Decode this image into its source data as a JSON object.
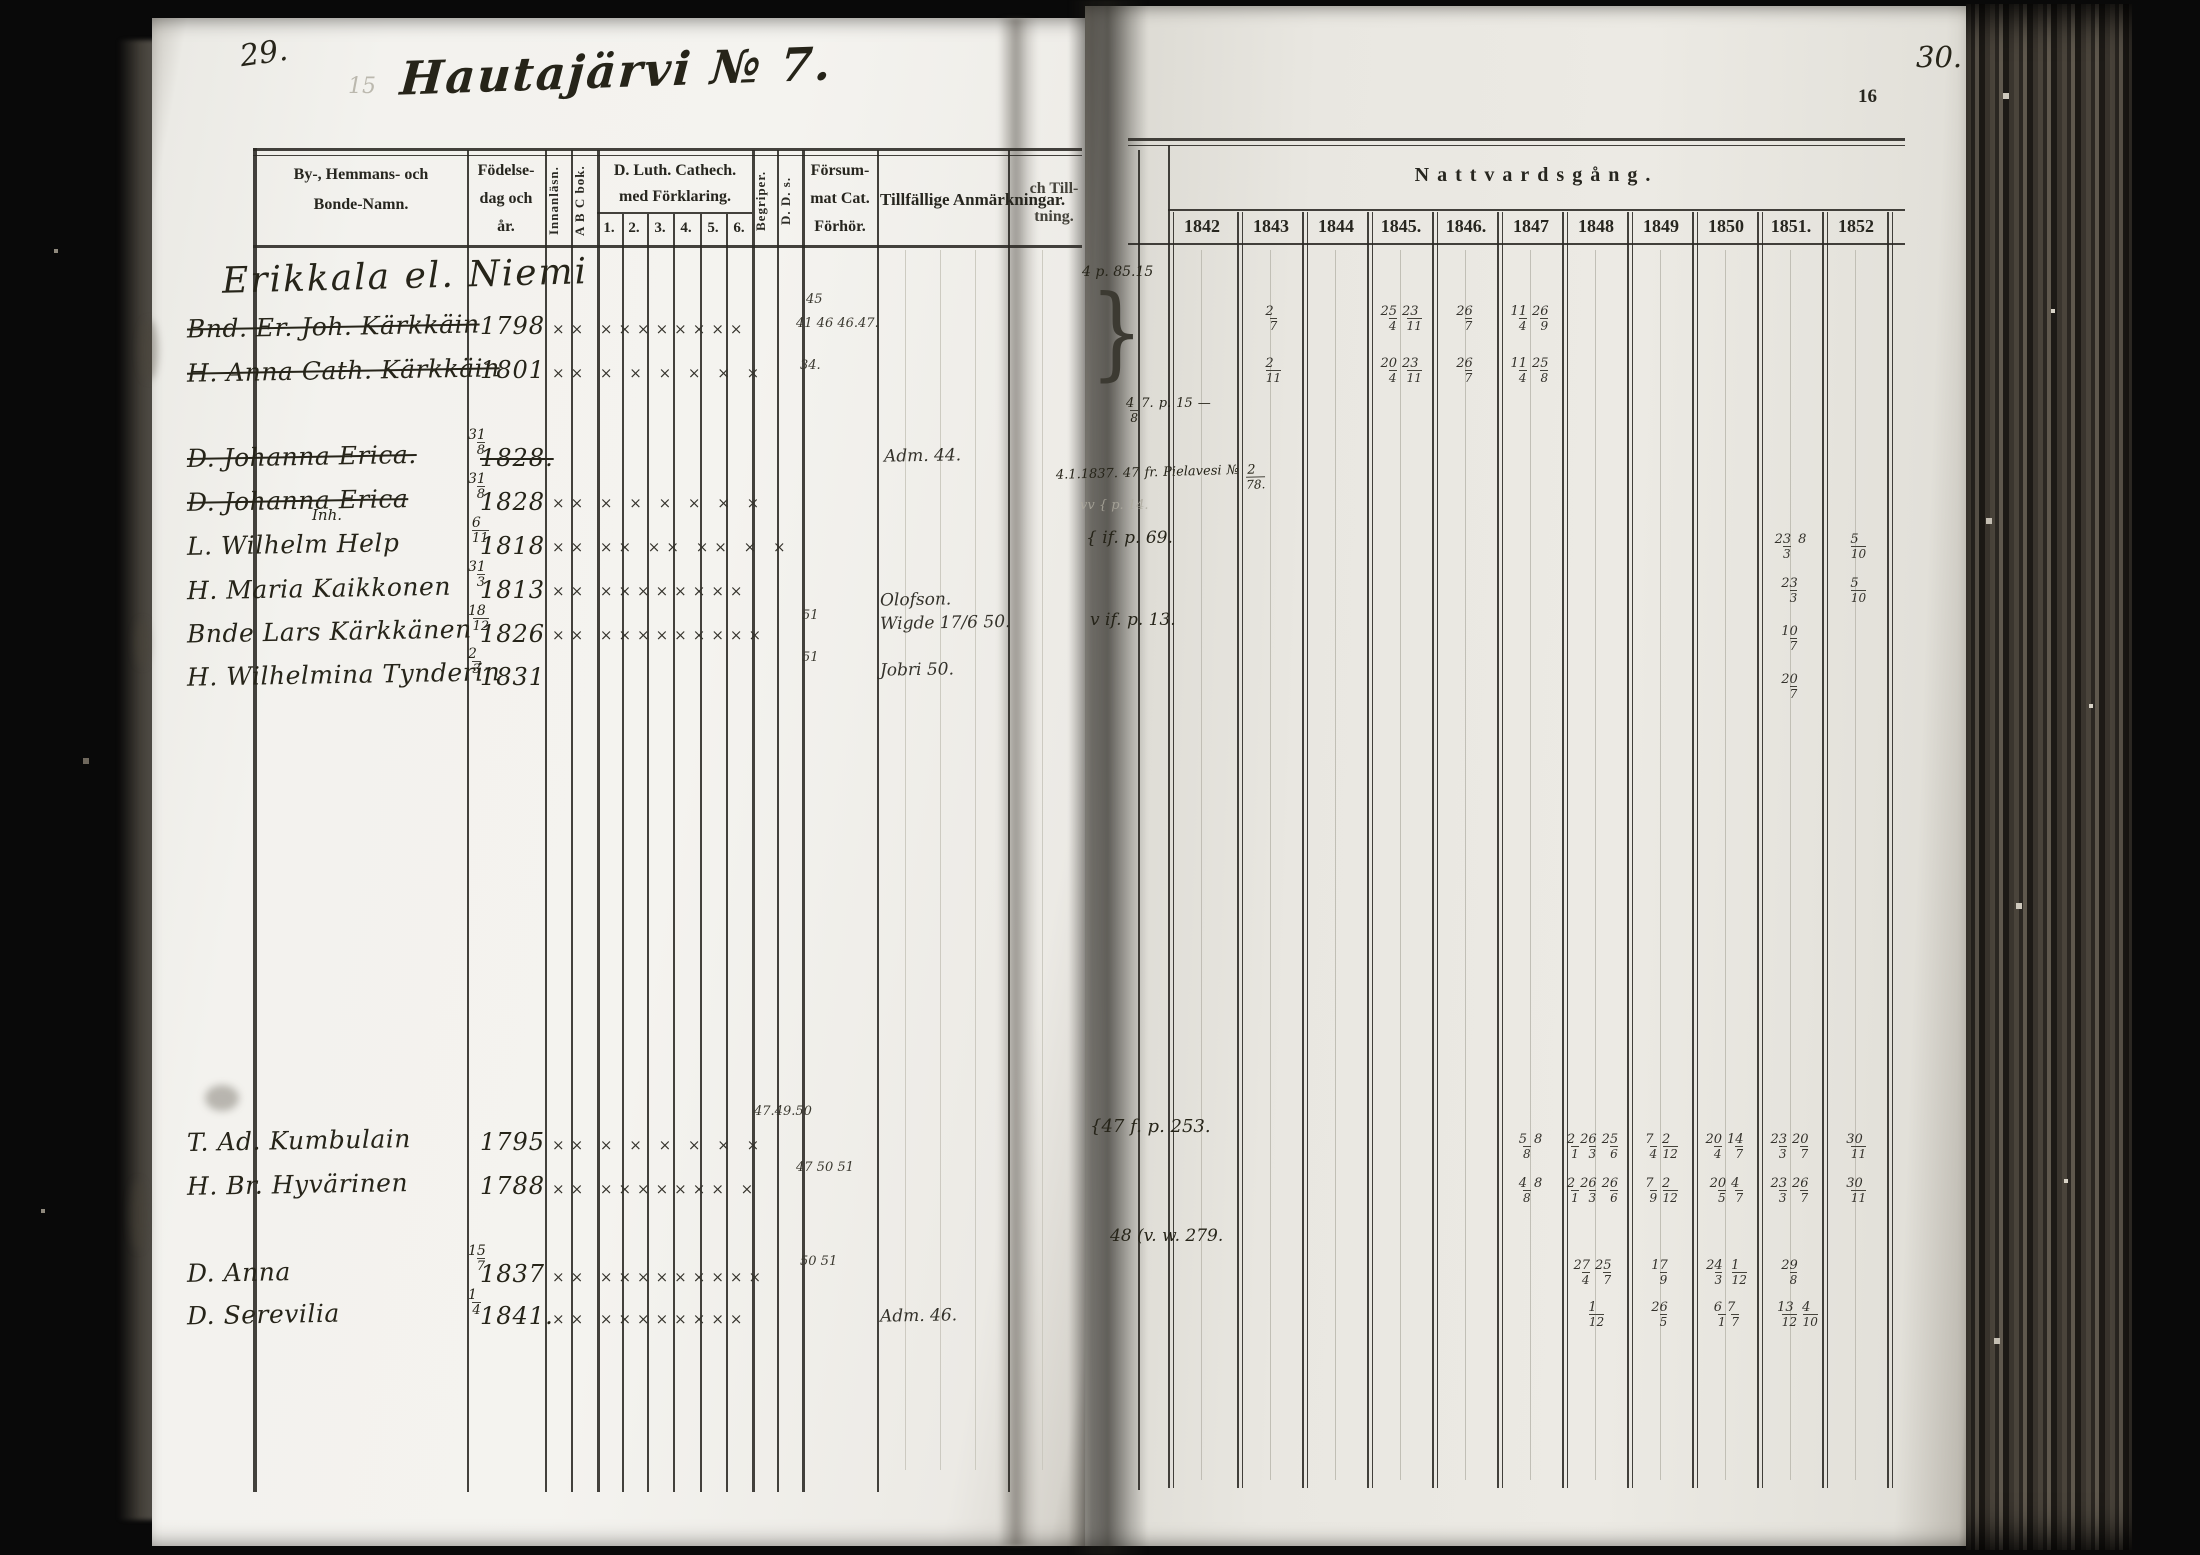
{
  "scan": {
    "left_folio": "29.",
    "ghost_number": "15",
    "title": "Hautajärvi № 7.",
    "right_folio": "30.",
    "printed_folio": "16",
    "section_heading": "Erikkala el. Niemi"
  },
  "headers": {
    "name_col": [
      "By-, Hemmans- och",
      "Bonde-Namn."
    ],
    "birth_col": [
      "Födelse-",
      "dag och",
      "år."
    ],
    "innanlasning": "Innanläsn.",
    "abc_book": "A B C bok.",
    "cathech": [
      "D. Luth. Cathech.",
      "med Förklaring."
    ],
    "cathech_nums": [
      "1.",
      "2.",
      "3.",
      "4.",
      "5.",
      "6."
    ],
    "begriper": "Begriper.",
    "dds": "D. D. s.",
    "forsummat": [
      "Försum-",
      "mat Cat.",
      "Förhör."
    ],
    "anmarkningar": "Tillfällige Anmärkningar.",
    "till_partial": [
      "ch Till-",
      "tning."
    ],
    "nattvardsgang": "Nattvardsgång.",
    "years": [
      "1842",
      "1843",
      "1844",
      "1845.",
      "1846.",
      "1847",
      "1848",
      "1849",
      "1850",
      "1851.",
      "1852"
    ]
  },
  "rows": [
    {
      "name": "Bnd. Er. Joh. Kärkkäin",
      "struck": true,
      "frac": "",
      "year": "1798",
      "marks": "×× ××××××××",
      "fors_top": "45",
      "fors": "41 46 46.47.",
      "anm": "",
      "comm": {
        "1843": "2/7",
        "1845": "25/4 23/11",
        "1846": "26/7",
        "1847": "11/4 26/9"
      }
    },
    {
      "name": "H. Anna Cath. Kärkkäin",
      "struck": true,
      "frac": "",
      "year": "1801",
      "marks": "×× × × × × × ×",
      "fors": "34.",
      "anm": "",
      "comm": {
        "1843": "2/11",
        "1845": "20/4 23/11",
        "1846": "26/7",
        "1847": "11/4 25/8"
      }
    },
    {
      "name": "D. Johanna Erica.",
      "struck": true,
      "frac": "31/8",
      "year": "1828.",
      "year_struck": true,
      "marks": "",
      "fors": "",
      "anm": "Adm. 44.",
      "comm": {}
    },
    {
      "name": "D. Johanna Erica",
      "struck": true,
      "frac": "31/8",
      "year": "1828",
      "marks": "×× × × × × × ×",
      "fors": "",
      "anm": "",
      "comm": {}
    },
    {
      "note": "Inh.",
      "name": "L. Wilhelm Help",
      "struck": false,
      "frac": "6/11",
      "year": "1818",
      "marks": "×× ×× ×× ×× × ×",
      "fors": "",
      "anm": "",
      "comm": {
        "1851": "23/3 8",
        "1852": "5/10"
      }
    },
    {
      "name": "H. Maria Kaikkonen",
      "struck": false,
      "frac": "31/3",
      "year": "1813",
      "marks": "×× ××××××××",
      "fors": "",
      "anm": "",
      "comm": {
        "1851": "23/3",
        "1852": "5/10"
      }
    },
    {
      "name": "Bnde Lars Kärkkänen",
      "struck": false,
      "frac": "18/12",
      "year": "1826",
      "marks": "×× ×××××××××",
      "fors": "51",
      "anm": "Olofson.",
      "anm2": "Wigde 17/6 50.",
      "comm": {
        "1851": "10/7"
      }
    },
    {
      "name": "H. Wilhelmina Tynderin",
      "struck": false,
      "frac": "2/3",
      "year": "1831",
      "marks": "",
      "fors": "51",
      "anm": "Jobri 50.",
      "comm": {
        "1851": "20/7"
      }
    },
    {
      "name": "T. Ad. Kumbulain",
      "struck": false,
      "frac": "",
      "year": "1795",
      "marks": "×× × × × × × ×",
      "fors_top": "47.49.50",
      "fors": "",
      "anm": "",
      "comm": {
        "1847": "5/8 8",
        "1848": "2/1 26/3 25/6",
        "1849": "7/4 2/12",
        "1850": "20/4 14/7",
        "1851": "23/3 20/7",
        "1852": "30/11"
      }
    },
    {
      "name": "H. Br. Hyvärinen",
      "struck": false,
      "frac": "",
      "year": "1788",
      "marks": "×× ××××××× ×",
      "fors": "47 50 51",
      "anm": "",
      "comm": {
        "1847": "4/8 8",
        "1848": "2/1 26/3 26/6",
        "1849": "7/9 2/12",
        "1850": "20/5 4/7",
        "1851": "23/3 26/7",
        "1852": "30/11"
      }
    },
    {
      "name": "D. Anna",
      "struck": false,
      "frac": "15/7",
      "year": "1837",
      "marks": "×× ×××××××××",
      "fors": "50 51",
      "anm": "",
      "comm": {
        "1848": "27/4 25/7",
        "1849": "17/9",
        "1850": "24/3 1/12",
        "1851": "29/8"
      }
    },
    {
      "name": "D. Serevilia",
      "struck": false,
      "frac": "1/4",
      "year": "1841.",
      "marks": "×× ××××××××",
      "fors": "",
      "anm": "Adm. 46.",
      "comm": {
        "1848": "1/12",
        "1849": "26/5",
        "1850": "6/1 7/7",
        "1851": "13/12 4/10"
      }
    }
  ],
  "spine_notes": [
    "4 p. 85.15",
    "}",
    "4/8 7. p. 15 —",
    "4.1.1837. 47 fr. Pielavesi № 2/78.",
    "vv { p. 14.",
    "{ if. p. 69.",
    "v if. p. 13.",
    "{47 f. p. 253.",
    "48 (v. w. 279."
  ]
}
